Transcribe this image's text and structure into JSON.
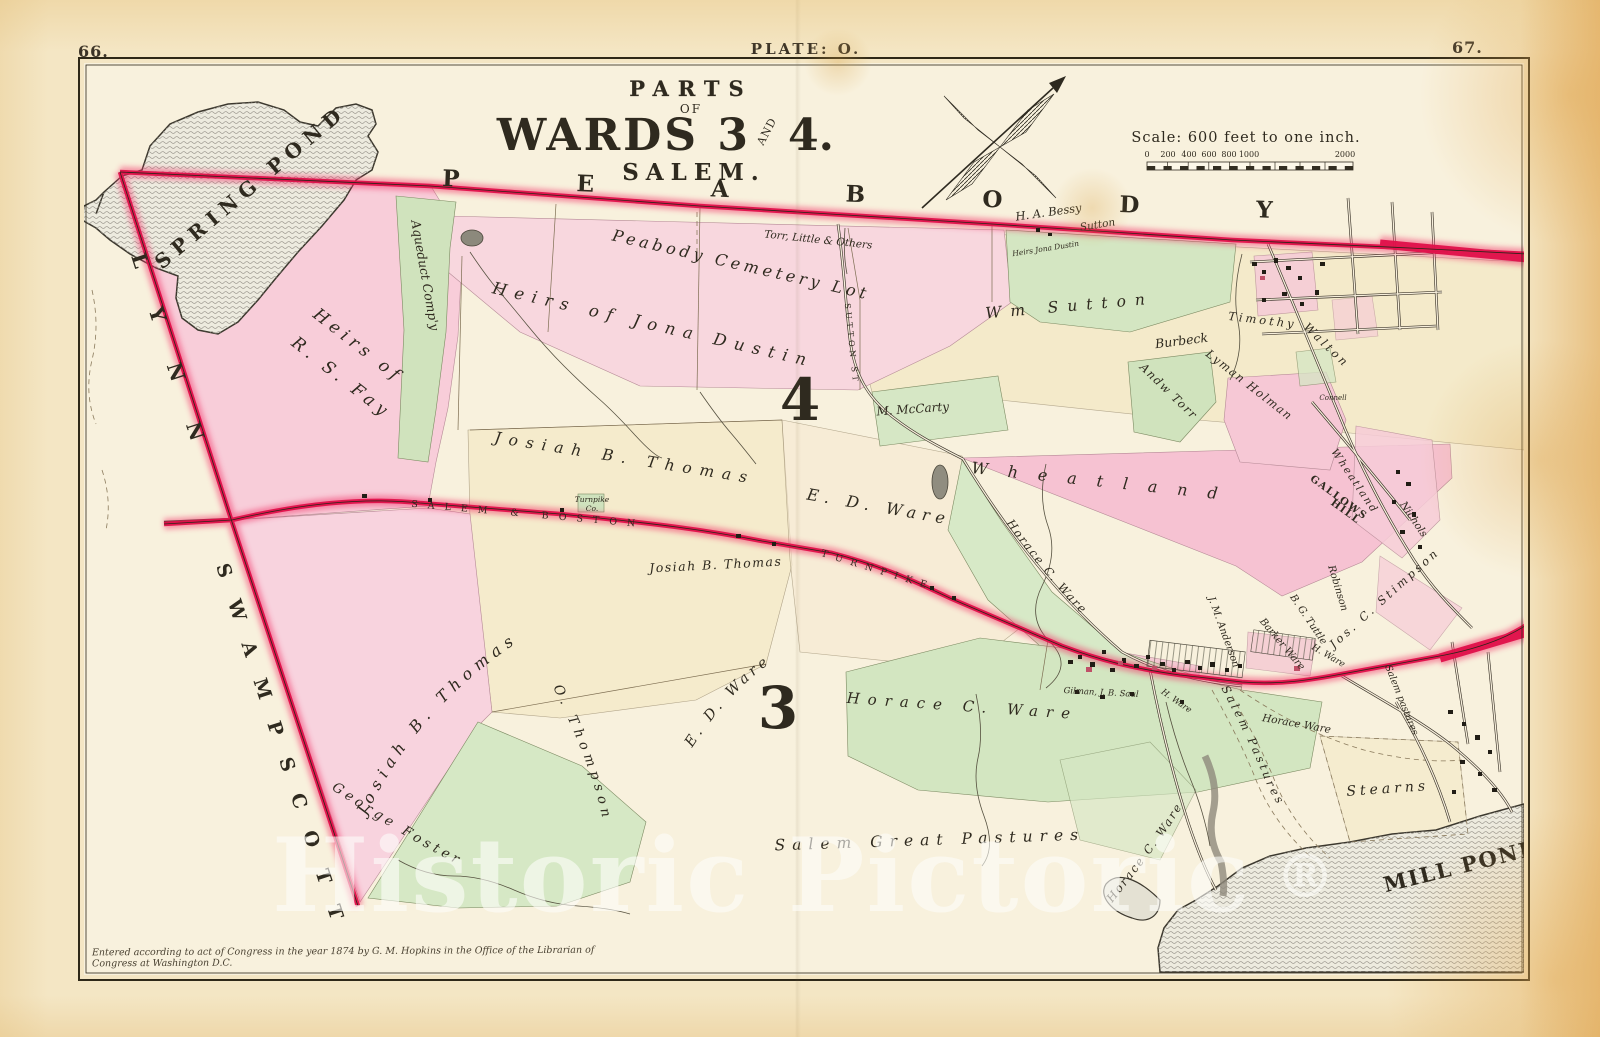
{
  "page": {
    "left_number": "66.",
    "plate": "PLATE: O.",
    "right_number": "67."
  },
  "title": {
    "parts": "PARTS",
    "of": "OF",
    "wards_left": "WARDS 3",
    "and_stamp": "AND",
    "wards_right": "4.",
    "city": "SALEM."
  },
  "scale": {
    "caption": "Scale: 600 feet to one inch.",
    "ticks": [
      "0",
      "200",
      "400",
      "600",
      "800",
      "1000",
      "2000"
    ]
  },
  "wards": {
    "four": "4",
    "three": "3"
  },
  "towns": {
    "peabody": "PEABODY",
    "lynn": "LYNN",
    "swampscott": "SWAMPSCOTT"
  },
  "water": {
    "spring_pond": "SPRING POND",
    "mill_pond": "MILL POND"
  },
  "roads": {
    "salem_boston": "SALEM & BOSTON",
    "turnpike": "TURNPIKE",
    "sutton_st": "SUTTON ST"
  },
  "labels": {
    "heirs_fay_line1": "Heirs of",
    "heirs_fay_line2": "R. S. Fay",
    "aqueduct": "Aqueduct Comp'y",
    "cemetery": "Peabody Cemetery Lot",
    "torr_little": "Torr, Little & Others",
    "bessy": "H. A. Bessy",
    "sutton_road": "Sutton",
    "dustin_small": "Heirs Jona Dustin",
    "heirs_dustin": "Heirs of Jona Dustin",
    "wm_sutton": "Wm Sutton",
    "burbeck": "Burbeck",
    "timothy": "Timothy",
    "walton": "Walton",
    "lyman_holman": "Lyman Holman",
    "andw_torr": "Andw Torr",
    "connell": "Connell",
    "mccarty": "M. McCarty",
    "wheatland": "Wheatland",
    "wheatland_small": "Wheatland",
    "gallows_line1": "GALLOWS",
    "gallows_line2": "HILL",
    "nichols": "Nichols",
    "robinson": "Robinson",
    "stimpson": "Jos. C. Stimpson",
    "tuttle": "B. G. Tuttle",
    "barker_ware": "Barker Ware",
    "anderson": "J. M. Anderson",
    "h_ware_a": "H. Ware",
    "h_ware_b": "H. Ware",
    "gilman_saul": "Gilman, J. B. Saul",
    "horace_ware_village": "Horace Ware",
    "salem_pastures_a": "Salem Pastures",
    "salem_pastures_b": "Salem pastures",
    "stearns": "Stearns",
    "josiah_thomas_1": "Josiah B. Thomas",
    "josiah_thomas_2": "Josiah B. Thomas",
    "josiah_thomas_3": "Josiah B. Thomas",
    "ed_ware_1": "E. D. Ware",
    "ed_ware_2": "E. D. Ware",
    "horace_c_mid": "Horace C. Ware",
    "horace_c_big": "Horace C. Ware",
    "horace_c_sw": "Horace C. Ware",
    "salem_great_pastures": "Salem Great Pastures",
    "george_foster": "George Foster",
    "o_thompson": "O. Thompson",
    "turnpike_co_line1": "Turnpike",
    "turnpike_co_line2": "Co."
  },
  "watermark": {
    "text": "Historic Pictoric",
    "reg": "®"
  },
  "copyright": "Entered according to act of Congress in the year 1874 by G. M. Hopkins in the Office of the Librarian of Congress at Washington D.C.",
  "colors": {
    "boundary_red": "#e0104a",
    "parcel_pink": "#f7cdd9",
    "parcel_green": "#d3e5c1",
    "parcel_cream": "#f4e9c4",
    "water_gray": "#edebdf"
  }
}
